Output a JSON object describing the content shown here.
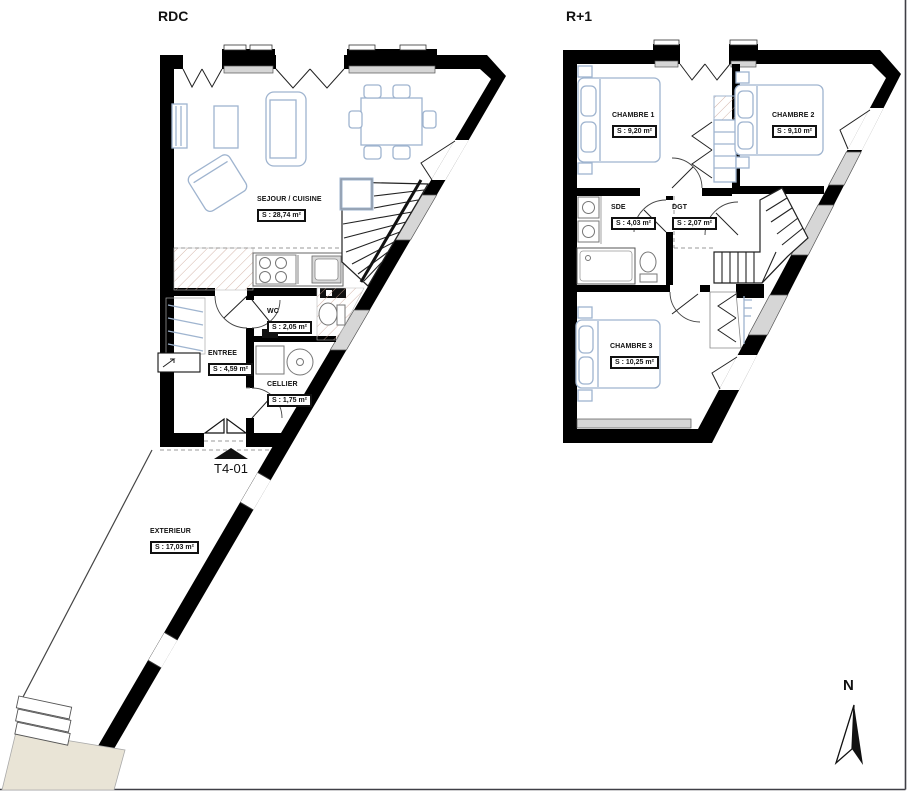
{
  "plans": [
    {
      "title": "RDC",
      "rooms": [
        {
          "name": "SEJOUR / CUISINE",
          "area": "S : 28,74 m²"
        },
        {
          "name": "WC",
          "area": "S : 2,05 m²"
        },
        {
          "name": "ENTREE",
          "area": "S : 4,59 m²"
        },
        {
          "name": "CELLIER",
          "area": "S : 1,75 m²"
        },
        {
          "name": "EXTERIEUR",
          "area": "S : 17,03 m²"
        }
      ]
    },
    {
      "title": "R+1",
      "rooms": [
        {
          "name": "CHAMBRE 1",
          "area": "S : 9,20 m²"
        },
        {
          "name": "CHAMBRE 2",
          "area": "S : 9,10 m²"
        },
        {
          "name": "SDE",
          "area": "S : 4,03 m²"
        },
        {
          "name": "DGT",
          "area": "S : 2,07 m²"
        },
        {
          "name": "CHAMBRE 3",
          "area": "S : 10,25 m²"
        }
      ]
    }
  ],
  "unit_label": "T4-01",
  "north_label": "N",
  "colors": {
    "wall": "#000000",
    "furniture": "#9fb4cf",
    "hatch": "#c79d8d",
    "window_fill": "#d6d6d6",
    "terrace": "#e9e4d6",
    "line": "#333333",
    "border": "#3f3f46"
  }
}
